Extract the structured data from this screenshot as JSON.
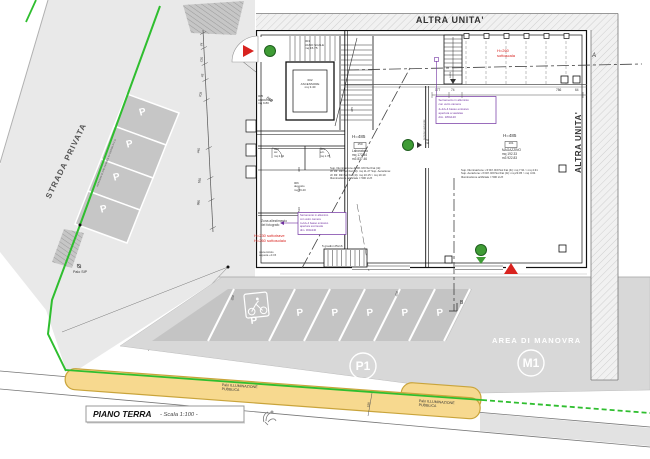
{
  "plan": {
    "labels": {
      "strada_privata": "STRADA PRIVATA",
      "altra_unita_top": "ALTRA UNITA'",
      "altra_unita_right": "ALTRA UNITA'",
      "area_di_manovra": "AREA DI MANOVRA",
      "m1": "M1",
      "p1": "P1",
      "stall_letter": "P",
      "palo_pubblica": "Palo ILLUMINAZIONE\nPUBBLICA",
      "palo_sip": "Palo SIP",
      "title": "PIANO TERRA",
      "title_scale": "- Scala 1:100 -",
      "section_a": "A",
      "section_b": "B"
    },
    "rooms": {
      "vano_scale": "001\nVANO SCALE\nmq 15.75",
      "ascensore": "002\nASCENSORE\nmq 3.40",
      "androne": "005\nANDRONE\nmq 9.80",
      "wc": "004\nwc\nmq 2.42",
      "antibagno": "003\na.b.\nmq 1.76",
      "deposito": "006\ndeposito\nmq 16.40",
      "laboratorio_h": "H=485",
      "laboratorio_num": "150",
      "laboratorio": "Laboratorio\nmq 172.84\nm3 837.46",
      "magazzino_h": "H=485",
      "magazzino_num": "101",
      "magazzino": "MAGAZZINO\nmq 192.33\nm3 922.83"
    },
    "notes": {
      "red_sottoscala": "H=260\nsottoscala",
      "red_sottotrave": "H=230 sottotrave\nH=260 sottosolaio",
      "zona": "Zona allestimento\ndel fotografo",
      "quota": "pianerottolo\na quota +0.15",
      "gradini": "5 gradini 25x16",
      "salita": "salita",
      "portone": "portone sezionale",
      "recinzione": "recinzione in rete metallica su cordolo in c.a.",
      "para_sx": "Sup. Illuminazione di Rif. Ril=Sol Fat (4i):\ncfr Rif. Ril=Sol Fat (4i): mq 11.27 Sup. Aerazione:\ncfr Rif. Ril=Sol Fat (4i): mq 10.15 > mq 10.10\nIlluminazione artificiale = 500 LUX",
      "para_dx": "Sup. Illuminazione: cfr Rif. Ril=Sol Fat (4i): mq 7.91 > mq 4.31\nSup. Aerazione: cfr Rif. Ril=Sol Fat (4i): mq 23.05 > mq 4.61\nIlluminazione artificiale = 500 LUX",
      "purple_sx": "Serramento in alluminio\ncon vetro camera\n4+12+4 basso emissivo\napertura scorrevole\ndim. 300x240",
      "purple_dx": "Serramento in alluminio\ncon vetro camera\n4+12+4 basso emissivo\napertura a vasistas\ndim. 180x120",
      "circle_note": "150\n210"
    },
    "dimensions": {
      "chain": [
        "24",
        "225",
        "45",
        "703",
        "445",
        "650",
        "985"
      ],
      "diagonal": "850",
      "top": [
        "177",
        "74",
        "786",
        "64"
      ],
      "stall_a": "250",
      "stall_b": "250",
      "strip": "150",
      "int_a": "385",
      "int_b": "300",
      "int_c": "810",
      "int_d": "510"
    },
    "colors": {
      "boundary_green": "#2FBE2F",
      "marker_green": "#3F9C35",
      "accent_red": "#D8231F",
      "note_purple": "#7030A0",
      "strip_yellow": "#F7D98F",
      "strip_border": "#C9A43B"
    }
  }
}
